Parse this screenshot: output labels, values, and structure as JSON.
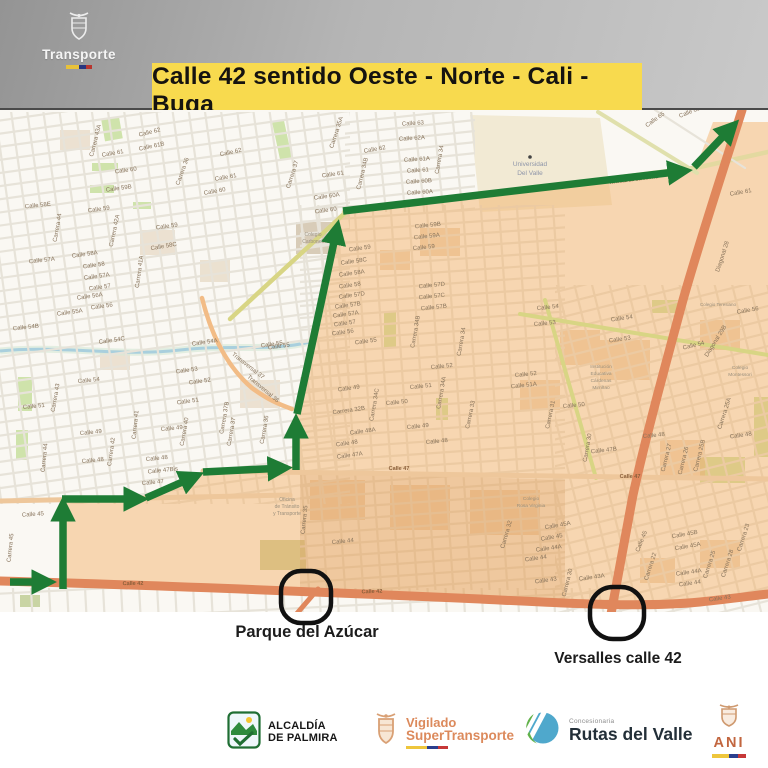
{
  "header": {
    "brand": "Transporte"
  },
  "banner": {
    "title": "Calle 42 sentido Oeste - Norte - Cali - Buga"
  },
  "annotations": {
    "parque": "Parque del Azúcar",
    "versalles": "Versalles calle 42"
  },
  "footer": {
    "alcaldia_line1": "ALCALDÍA",
    "alcaldia_line2": "DE PALMIRA",
    "vigilado_line1": "Vigilado",
    "vigilado_line2": "SuperTransporte",
    "concesionaria": "Concesionaria",
    "rutas": "Rutas del Valle",
    "ani": "ANI"
  },
  "colors": {
    "banner_yellow": "#f8da4e",
    "route_green": "#1e7c35",
    "zone_peach": "#f8d6b1",
    "road_orange": "#e0875c",
    "road_tan": "#eec79b",
    "circle_black": "#111111",
    "header_gray": "#a8a8a8",
    "flag_yellow": "#eec63c",
    "flag_blue": "#2b3f8e",
    "flag_red": "#c63838"
  },
  "map": {
    "street_labels": [
      [
        "Calle 62",
        150,
        134,
        -14
      ],
      [
        "Carrera 43A",
        97,
        141,
        -76
      ],
      [
        "Calle 61B",
        152,
        148,
        -12
      ],
      [
        "Calle 61",
        113,
        155,
        -10
      ],
      [
        "Calle 60",
        126,
        172,
        -8
      ],
      [
        "Calle 59B",
        119,
        190,
        -8
      ],
      [
        "Calle 58E",
        38,
        207,
        -6
      ],
      [
        "Calle 59",
        99,
        211,
        -8
      ],
      [
        "Carrera 44",
        59,
        228,
        -80
      ],
      [
        "Calle 59",
        167,
        228,
        -8
      ],
      [
        "Carrera 42A",
        116,
        231,
        -78
      ],
      [
        "Calle 58C",
        164,
        248,
        -10
      ],
      [
        "Calle 58A",
        85,
        256,
        -8
      ],
      [
        "Carrera 41A",
        141,
        272,
        -82
      ],
      [
        "Calle 58",
        94,
        267,
        -8
      ],
      [
        "Calle 57A",
        42,
        262,
        -6
      ],
      [
        "Calle 57A",
        97,
        278,
        -8
      ],
      [
        "Calle 57",
        100,
        289,
        -8
      ],
      [
        "Calle 56A",
        90,
        298,
        -8
      ],
      [
        "Calle 56",
        102,
        308,
        -8
      ],
      [
        "Calle 55A",
        70,
        314,
        -8
      ],
      [
        "Calle 54B",
        26,
        329,
        -6
      ],
      [
        "Calle 54C",
        112,
        342,
        -8
      ],
      [
        "Calle 54",
        89,
        382,
        -6
      ],
      [
        "Carrera 43",
        57,
        398,
        -80
      ],
      [
        "Calle 51",
        34,
        408,
        -6
      ],
      [
        "Calle 49",
        91,
        434,
        -6
      ],
      [
        "Carrera 42",
        113,
        452,
        -82
      ],
      [
        "Carrera 41",
        137,
        425,
        -84
      ],
      [
        "Calle 48",
        93,
        462,
        -6
      ],
      [
        "Calle 48",
        157,
        460,
        -6
      ],
      [
        "Calle 47Bis",
        163,
        472,
        -6
      ],
      [
        "Calle 47",
        153,
        484,
        -6
      ],
      [
        "Calle 45",
        33,
        516,
        -4
      ],
      [
        "Carrera 45",
        12,
        548,
        -84
      ],
      [
        "Carrera 44",
        46,
        458,
        -84
      ],
      [
        "Carrera 36",
        184,
        172,
        -70
      ],
      [
        "Calle 62",
        231,
        154,
        -12
      ],
      [
        "Calle 61",
        226,
        179,
        -10
      ],
      [
        "Calle 60",
        215,
        193,
        -10
      ],
      [
        "Carrera 35A",
        338,
        133,
        -72
      ],
      [
        "Calle 62",
        375,
        151,
        -10
      ],
      [
        "Carrera 37",
        294,
        175,
        -72
      ],
      [
        "Calle 61",
        333,
        176,
        -8
      ],
      [
        "Carrera 34B",
        364,
        174,
        -76
      ],
      [
        "Calle 60A",
        327,
        198,
        -8
      ],
      [
        "Calle 60",
        326,
        212,
        -8
      ],
      [
        "Calle 63",
        413,
        125,
        -4
      ],
      [
        "Calle 62A",
        412,
        140,
        -4
      ],
      [
        "Calle 61A",
        417,
        161,
        -4
      ],
      [
        "Calle 61",
        418,
        172,
        -4
      ],
      [
        "Calle 60B",
        419,
        183,
        -4
      ],
      [
        "Calle 60A",
        420,
        194,
        -4
      ],
      [
        "Carrera 34",
        441,
        160,
        -80
      ],
      [
        "Calle 65",
        656,
        121,
        -36
      ],
      [
        "Calle 65A",
        692,
        113,
        -22
      ],
      [
        "Calle 61",
        741,
        194,
        -10
      ],
      [
        "Calle 59B",
        428,
        227,
        -6
      ],
      [
        "Calle 59A",
        427,
        238,
        -6
      ],
      [
        "Calle 59",
        424,
        249,
        -6
      ],
      [
        "Calle 59",
        360,
        250,
        -8
      ],
      [
        "Calle 58C",
        354,
        263,
        -8
      ],
      [
        "Calle 58A",
        352,
        275,
        -8
      ],
      [
        "Calle 58",
        350,
        287,
        -8
      ],
      [
        "Calle 57D",
        352,
        297,
        -8
      ],
      [
        "Calle 57B",
        348,
        307,
        -8
      ],
      [
        "Calle 57A",
        346,
        316,
        -8
      ],
      [
        "Calle 57",
        345,
        325,
        -8
      ],
      [
        "Calle 56",
        343,
        334,
        -8
      ],
      [
        "Calle 55",
        366,
        343,
        -8
      ],
      [
        "Calle 55",
        279,
        348,
        -8
      ],
      [
        "Calle 57D",
        432,
        287,
        -6
      ],
      [
        "Calle 57C",
        432,
        298,
        -6
      ],
      [
        "Calle 57B",
        434,
        309,
        -6
      ],
      [
        "Carrera 34C",
        376,
        405,
        -80
      ],
      [
        "Carrera 34B",
        417,
        332,
        -80
      ],
      [
        "Carrera 34A",
        443,
        393,
        -80
      ],
      [
        "Carrera 34",
        463,
        342,
        -80
      ],
      [
        "Carrera 33",
        472,
        415,
        -78
      ],
      [
        "Calle 52",
        442,
        368,
        -6
      ],
      [
        "Calle 51",
        421,
        388,
        -6
      ],
      [
        "Calle 50",
        397,
        404,
        -6
      ],
      [
        "Calle 49",
        418,
        428,
        -6
      ],
      [
        "Calle 49",
        349,
        390,
        -8
      ],
      [
        "Carrera 32B",
        349,
        412,
        -8
      ],
      [
        "Calle 48A",
        363,
        433,
        -8
      ],
      [
        "Calle 48",
        347,
        445,
        -8
      ],
      [
        "Calle 47A",
        350,
        457,
        -8
      ],
      [
        "Calle 48",
        437,
        443,
        -6
      ],
      [
        "Calle 54A",
        205,
        344,
        -8
      ],
      [
        "Calle 55",
        272,
        346,
        -8
      ],
      [
        "Calle 53",
        187,
        372,
        -8
      ],
      [
        "Calle 52",
        200,
        383,
        -8
      ],
      [
        "Calle 51",
        188,
        403,
        -8
      ],
      [
        "Calle 49",
        172,
        430,
        -6
      ],
      [
        "Transversal 37",
        247,
        367,
        38
      ],
      [
        "Transversal 36",
        262,
        390,
        40
      ],
      [
        "Carrera 40",
        186,
        432,
        -80
      ],
      [
        "Carrera 37B",
        226,
        418,
        -80
      ],
      [
        "Carrera 37",
        233,
        432,
        -80
      ],
      [
        "Carrera 36",
        266,
        430,
        -80
      ],
      [
        "Carrera 35",
        306,
        520,
        -84
      ],
      [
        "Calle 54",
        548,
        309,
        -6
      ],
      [
        "Calle 53",
        545,
        325,
        -6
      ],
      [
        "Calle 54",
        622,
        320,
        -8
      ],
      [
        "Calle 53",
        620,
        341,
        -8
      ],
      [
        "Calle 54",
        694,
        347,
        -14
      ],
      [
        "Calle 52",
        526,
        376,
        -6
      ],
      [
        "Calle 51A",
        524,
        387,
        -6
      ],
      [
        "Carrera 31",
        552,
        415,
        -78
      ],
      [
        "Calle 50",
        574,
        407,
        -6
      ],
      [
        "Carrera 30",
        589,
        448,
        -80
      ],
      [
        "Calle 47B",
        604,
        452,
        -6
      ],
      [
        "Calle 48",
        654,
        437,
        -6
      ],
      [
        "Carrera 27",
        668,
        458,
        -76
      ],
      [
        "Carrera 26",
        685,
        461,
        -76
      ],
      [
        "Carrera 25B",
        701,
        456,
        -76
      ],
      [
        "Carrera 25A",
        726,
        414,
        -72
      ],
      [
        "Calle 48",
        741,
        437,
        -8
      ],
      [
        "Diagonal 29B",
        717,
        342,
        -58
      ],
      [
        "Calle 56",
        748,
        312,
        -10
      ],
      [
        "Diagonal 28",
        724,
        257,
        -72
      ],
      [
        "Calle 45A",
        558,
        527,
        -10
      ],
      [
        "Calle 45",
        552,
        539,
        -10
      ],
      [
        "Calle 44A",
        549,
        550,
        -8
      ],
      [
        "Calle 44",
        536,
        560,
        -8
      ],
      [
        "Calle 43",
        546,
        582,
        -8
      ],
      [
        "Carrera 30",
        569,
        583,
        -76
      ],
      [
        "Calle 43A",
        592,
        579,
        -8
      ],
      [
        "Calle 45",
        643,
        542,
        -68
      ],
      [
        "Carrera 22",
        652,
        567,
        -72
      ],
      [
        "Calle 45B",
        685,
        536,
        -10
      ],
      [
        "Calle 45A",
        688,
        548,
        -10
      ],
      [
        "Calle 44A",
        689,
        574,
        -8
      ],
      [
        "Calle 44",
        690,
        585,
        -8
      ],
      [
        "Carrera 25",
        711,
        565,
        -72
      ],
      [
        "Carrera 28",
        729,
        564,
        -72
      ],
      [
        "Carrera 23",
        745,
        538,
        -72
      ],
      [
        "Calle 43",
        720,
        600,
        -8
      ],
      [
        "Calle 44",
        343,
        543,
        -6
      ],
      [
        "Carrera 32",
        508,
        535,
        -74
      ]
    ],
    "road_labels": [
      [
        "Calle 42",
        133,
        585,
        -1
      ],
      [
        "Calle 42",
        372,
        593,
        -2
      ],
      [
        "Calle 47",
        399,
        470,
        0
      ],
      [
        "Calle 47",
        630,
        478,
        0
      ],
      [
        "Calle 46",
        82,
        501,
        -2
      ],
      [
        "Avenida La Carbonera",
        634,
        181,
        -7
      ]
    ],
    "poi_labels": [
      [
        "Universidad",
        530,
        166,
        6.5,
        "#8e95a9"
      ],
      [
        "Del Valle",
        530,
        175,
        6.5,
        "#8e95a9"
      ],
      [
        "Colegio",
        313,
        236,
        5,
        "#9a8f7c"
      ],
      [
        "Carbonell",
        313,
        243,
        5,
        "#9a8f7c"
      ],
      [
        "Oficina",
        287,
        501,
        5,
        "#9a8f7c"
      ],
      [
        "de Tránsito",
        287,
        508,
        5,
        "#9a8f7c"
      ],
      [
        "y Transporte",
        287,
        515,
        5,
        "#9a8f7c"
      ],
      [
        "Institución",
        601,
        368,
        4.8,
        "#9a8f7c"
      ],
      [
        "Educativa",
        601,
        375,
        4.8,
        "#9a8f7c"
      ],
      [
        "Cárdenas",
        601,
        382,
        4.8,
        "#9a8f7c"
      ],
      [
        "Mirriñao",
        601,
        389,
        4.8,
        "#9a8f7c"
      ],
      [
        "Colegio",
        740,
        369,
        4.8,
        "#9a8f7c"
      ],
      [
        "Montessori",
        740,
        376,
        4.8,
        "#9a8f7c"
      ],
      [
        "Colegio Teresiano",
        718,
        306,
        4.5,
        "#9a8f7c"
      ],
      [
        "Colegio",
        531,
        500,
        4.8,
        "#9a8f7c"
      ],
      [
        "Rosa Virginia",
        531,
        507,
        4.8,
        "#9a8f7c"
      ]
    ]
  }
}
